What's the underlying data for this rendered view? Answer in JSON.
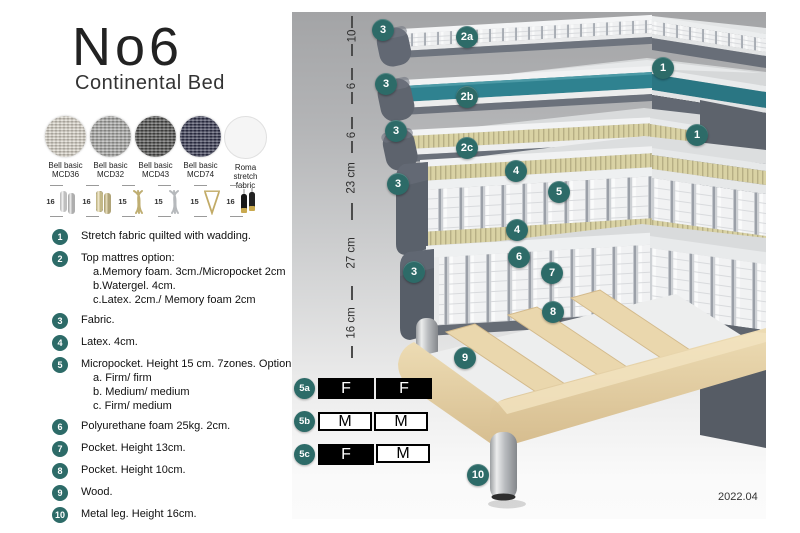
{
  "header": {
    "title": "No6",
    "subtitle": "Continental Bed"
  },
  "fabrics": [
    {
      "line1": "Bell basic",
      "line2": "MCD36",
      "color": "#d8d3c7"
    },
    {
      "line1": "Bell basic",
      "line2": "MCD32",
      "color": "#a7a7a5"
    },
    {
      "line1": "Bell basic",
      "line2": "MCD43",
      "color": "#4c4c4a"
    },
    {
      "line1": "Bell basic",
      "line2": "MCD74",
      "color": "#32344e"
    },
    {
      "line1": "Roma",
      "line2": "stretch fabric",
      "color": "#f5f5f5"
    }
  ],
  "legs": [
    {
      "height": "16",
      "type": "cylinder-silver"
    },
    {
      "height": "16",
      "type": "cylinder-gold"
    },
    {
      "height": "15",
      "type": "twisted-gold"
    },
    {
      "height": "15",
      "type": "twisted-silver"
    },
    {
      "height": "15",
      "type": "hairpin-gold"
    },
    {
      "height": "16",
      "type": "cylinder-black-gold"
    }
  ],
  "list": [
    {
      "num": "1",
      "text": "Stretch fabric quilted with wadding."
    },
    {
      "num": "2",
      "text": "Top mattres option:",
      "subs": [
        "a.Memory foam. 3cm./Micropocket 2cm",
        "b.Watergel. 4cm.",
        "c.Latex. 2cm./ Memory foam 2cm"
      ]
    },
    {
      "num": "3",
      "text": "Fabric."
    },
    {
      "num": "4",
      "text": "Latex. 4cm."
    },
    {
      "num": "5",
      "text": "Micropocket. Height 15 cm. 7zones. Option:",
      "subs": [
        "a. Firm/ firm",
        "b. Medium/ medium",
        "c. Firm/ medium"
      ]
    },
    {
      "num": "6",
      "text": "Polyurethane foam 25kg. 2cm."
    },
    {
      "num": "7",
      "text": "Pocket. Height 13cm."
    },
    {
      "num": "8",
      "text": "Pocket. Height 10cm."
    },
    {
      "num": "9",
      "text": "Wood."
    },
    {
      "num": "10",
      "text": "Metal leg. Height 16cm."
    }
  ],
  "diagram": {
    "dimensions": [
      {
        "label": "10"
      },
      {
        "label": "6"
      },
      {
        "label": "6"
      },
      {
        "label": "23 cm"
      },
      {
        "label": "27 cm"
      },
      {
        "label": "16 cm"
      }
    ],
    "badges": [
      {
        "label": "3"
      },
      {
        "label": "2a"
      },
      {
        "label": "1"
      },
      {
        "label": "3"
      },
      {
        "label": "2b"
      },
      {
        "label": "1"
      },
      {
        "label": "3"
      },
      {
        "label": "2c"
      },
      {
        "label": "3"
      },
      {
        "label": "4"
      },
      {
        "label": "5"
      },
      {
        "label": "4"
      },
      {
        "label": "6"
      },
      {
        "label": "7"
      },
      {
        "label": "3"
      },
      {
        "label": "8"
      },
      {
        "label": "9"
      },
      {
        "label": "10"
      }
    ],
    "firmness": [
      {
        "id": "5a",
        "cells": [
          {
            "letter": "F",
            "style": "dark"
          },
          {
            "letter": "F",
            "style": "dark"
          }
        ]
      },
      {
        "id": "5b",
        "cells": [
          {
            "letter": "M",
            "style": "light"
          },
          {
            "letter": "M",
            "style": "light"
          }
        ]
      },
      {
        "id": "5c",
        "cells": [
          {
            "letter": "F",
            "style": "dark"
          },
          {
            "letter": "M",
            "style": "light"
          }
        ]
      }
    ],
    "version": "2022.04"
  },
  "colors": {
    "badge_teal": "#2d6b68",
    "watergel_teal": "#2f8290",
    "latex_khaki": "#d9d2a4",
    "wood": "#e6d2a6",
    "mattress_gray": "#5d636d"
  }
}
